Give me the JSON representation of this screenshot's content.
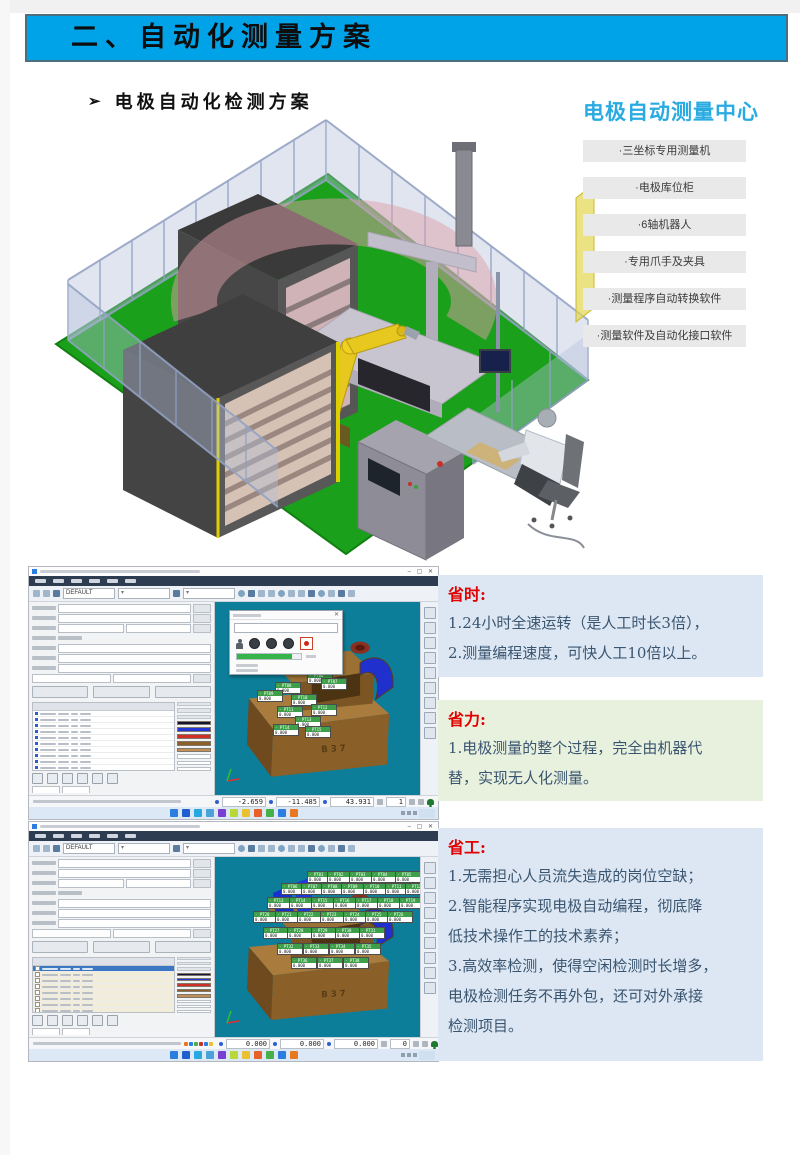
{
  "colors": {
    "accent": "#00A3E8",
    "brand": "#29ABE2",
    "viewport_teal": "#0d7e99",
    "floor_green": "#1ba01b",
    "robot_yellow": "#e6c81e",
    "benefit_blue": "#dce7f3",
    "benefit_green": "#e8f1de",
    "red_title": "#e20000"
  },
  "banner": {
    "title": "二、自动化测量方案"
  },
  "subtitle": {
    "bullet": "➢",
    "text": "电极自动化检测方案"
  },
  "center": {
    "title": "电极自动测量中心",
    "items": [
      "·三坐标专用测量机",
      "·电极库位柜",
      "·6轴机器人",
      "·专用爪手及夹具",
      "·测量程序自动转换软件",
      "·测量软件及自动化接口软件"
    ]
  },
  "benefits": [
    {
      "title": "省时:",
      "bg": "#dce7f3",
      "geom": {
        "x": 438,
        "y": 575,
        "w": 325,
        "h": 102
      },
      "lines": [
        "1.24小时全速运转（是人工时长3倍），",
        "2.测量编程速度，可快人工10倍以上。"
      ]
    },
    {
      "title": "省力:",
      "bg": "#e8f1de",
      "geom": {
        "x": 438,
        "y": 700,
        "w": 325,
        "h": 101
      },
      "lines": [
        "1.电极测量的整个过程，完全由机器代",
        "替，实现无人化测量。"
      ]
    },
    {
      "title": "省工:",
      "bg": "#dce7f3",
      "geom": {
        "x": 438,
        "y": 828,
        "w": 325,
        "h": 233
      },
      "lines": [
        "1.无需担心人员流失造成的岗位空缺；",
        "2.智能程序实现电极自动编程，彻底降",
        "低技术操作工的技术素养；",
        "3.高效率检测，使得空闲检测时长增多，",
        "电极检测任务不再外包，还可对外承接",
        "检测项目。"
      ]
    }
  ],
  "software": {
    "window_controls": "–  ▢  ✕",
    "dialog_close": "✕",
    "point_prefix": "PT",
    "point_value": "0.000",
    "swatches": [
      "#141432",
      "#2336d8",
      "#d03028",
      "#8a5f28",
      "#c09058"
    ],
    "taskbar_colors": [
      "#2b7de0",
      "#1f5fd0",
      "#28a8e0",
      "#4aa3d8",
      "#7a3fd0",
      "#b8d838",
      "#e8c030",
      "#e86028",
      "#48b048",
      "#2b7de0",
      "#e87820"
    ],
    "mini_colors": [
      "#e87820",
      "#2b7de0",
      "#48b048",
      "#d03028",
      "#2b7de0",
      "#e8c030"
    ],
    "windows": [
      {
        "variant": "w1",
        "geom": {
          "x": 28,
          "y": 566,
          "w": 411,
          "h": 254
        },
        "preset": "DEFAULT",
        "model_label": "B37",
        "dialog": true,
        "table_rows": 22,
        "status": {
          "x": "-2.659",
          "y": "-11.485",
          "z": "43.931",
          "count": "1"
        },
        "points": [
          [
            44,
            24
          ],
          [
            56,
            40
          ],
          [
            66,
            52
          ],
          [
            84,
            58
          ],
          [
            100,
            54
          ],
          [
            92,
            70
          ],
          [
            106,
            76
          ],
          [
            60,
            80
          ],
          [
            42,
            88
          ],
          [
            76,
            92
          ],
          [
            62,
            104
          ],
          [
            96,
            102
          ],
          [
            80,
            114
          ],
          [
            58,
            122
          ],
          [
            90,
            124
          ]
        ]
      },
      {
        "variant": "w2",
        "geom": {
          "x": 28,
          "y": 821,
          "w": 411,
          "h": 241
        },
        "preset": "DEFAULT",
        "model_label": "B37",
        "dialog": false,
        "table_rows": 20,
        "status": {
          "x": "0.000",
          "y": "0.000",
          "z": "0.000",
          "count": "0"
        },
        "points": [
          [
            92,
            14
          ],
          [
            112,
            14
          ],
          [
            134,
            14
          ],
          [
            156,
            14
          ],
          [
            180,
            14
          ],
          [
            66,
            26
          ],
          [
            86,
            26
          ],
          [
            106,
            26
          ],
          [
            126,
            26
          ],
          [
            148,
            26
          ],
          [
            170,
            26
          ],
          [
            190,
            26
          ],
          [
            52,
            40
          ],
          [
            74,
            40
          ],
          [
            96,
            40
          ],
          [
            118,
            40
          ],
          [
            140,
            40
          ],
          [
            162,
            40
          ],
          [
            184,
            40
          ],
          [
            38,
            54
          ],
          [
            60,
            54
          ],
          [
            82,
            54
          ],
          [
            105,
            54
          ],
          [
            128,
            54
          ],
          [
            150,
            54
          ],
          [
            172,
            54
          ],
          [
            48,
            70
          ],
          [
            72,
            70
          ],
          [
            96,
            70
          ],
          [
            120,
            70
          ],
          [
            144,
            70
          ],
          [
            62,
            86
          ],
          [
            88,
            86
          ],
          [
            114,
            86
          ],
          [
            140,
            86
          ],
          [
            76,
            100
          ],
          [
            102,
            100
          ],
          [
            128,
            100
          ]
        ]
      }
    ]
  }
}
